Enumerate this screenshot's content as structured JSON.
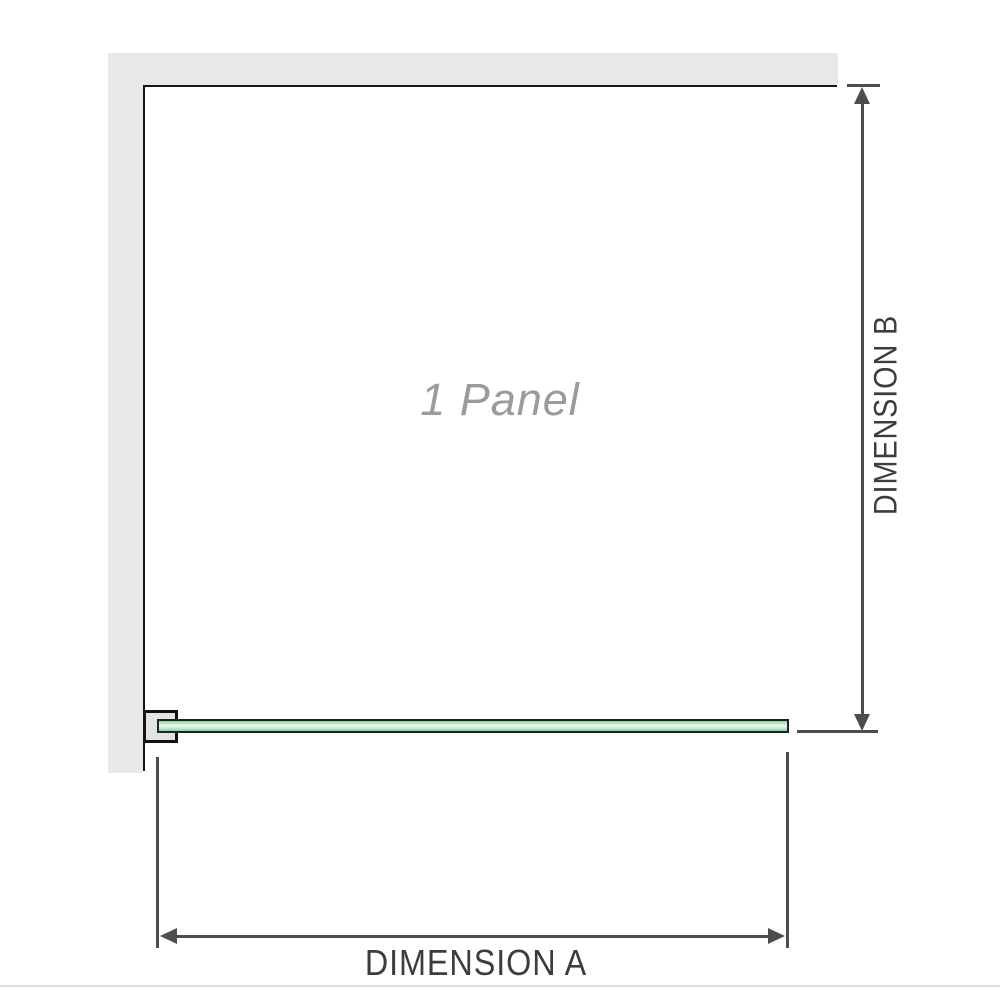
{
  "diagram": {
    "type": "shower-screen-panel-dimension-diagram",
    "panel_label": "1 Panel",
    "dimension_a_label": "DIMENSION A",
    "dimension_b_label": "DIMENSION B",
    "parts": {
      "wall": "L-shaped wall strip along top and left",
      "bracket": "wall-mount bracket clamping glass panel at bottom left",
      "glass_panel": "horizontal glass panel bar at bottom (plan view)",
      "dimension_a": "horizontal width dimension with double-headed arrow",
      "dimension_b": "vertical height dimension with double-headed arrow"
    },
    "arrows": [
      "up",
      "down",
      "left",
      "right"
    ]
  },
  "colors": {
    "background": "#ffffff",
    "wall_fill": "#e8e8e8",
    "panel_outline": "#151515",
    "bracket_border": "#111111",
    "bracket_fill": "#e3e3e3",
    "glass_border": "#16281c",
    "glass_fill_edge": "#8ecfa9",
    "glass_fill_center": "#ecf9f1",
    "dimension_line": "#4d4d4d",
    "dimension_label_text": "#3d3d3d",
    "panel_label_text": "#9b9b9b",
    "bottom_divider": "#dcdcdc"
  }
}
